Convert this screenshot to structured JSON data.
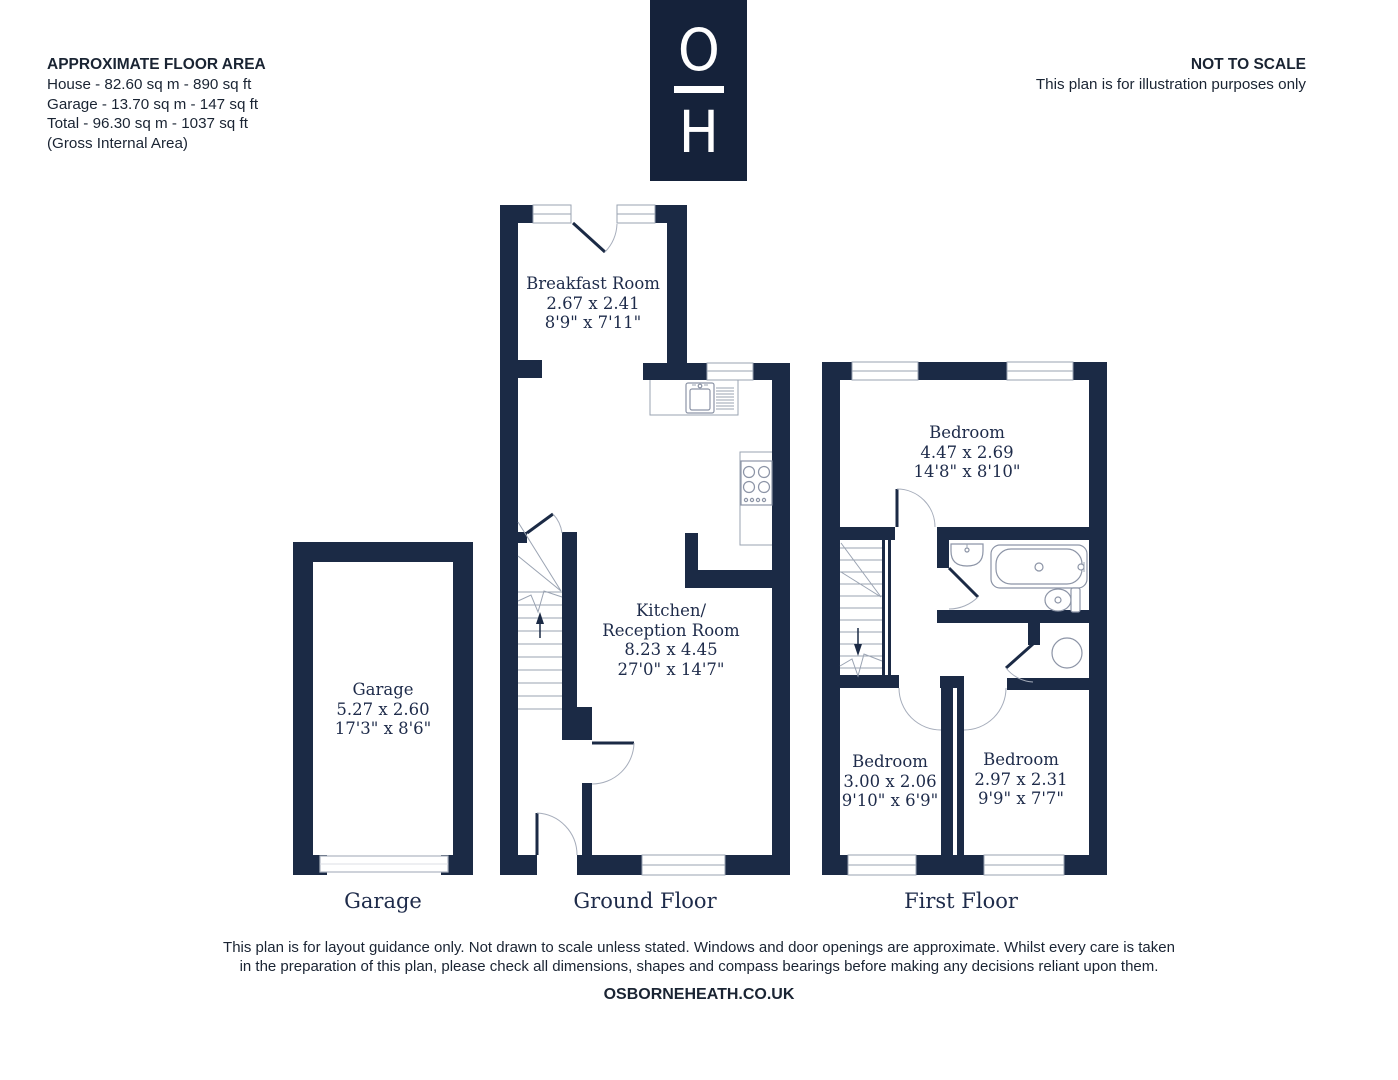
{
  "header": {
    "floor_area": {
      "title": "APPROXIMATE FLOOR AREA",
      "line1": "House - 82.60 sq m - 890 sq ft",
      "line2": "Garage - 13.70 sq m - 147 sq ft",
      "line3": "Total - 96.30 sq m - 1037 sq ft",
      "line4": "(Gross Internal Area)"
    },
    "scale_note": {
      "title": "NOT TO SCALE",
      "subtitle": "This plan is for illustration purposes only"
    }
  },
  "logo": {
    "letter_top": "O",
    "letter_bottom": "H"
  },
  "rooms": {
    "breakfast": {
      "name": "Breakfast Room",
      "metric": "2.67 x 2.41",
      "imperial": "8'9\" x 7'11\""
    },
    "kitchen": {
      "name_line1": "Kitchen/",
      "name_line2": "Reception Room",
      "metric": "8.23 x 4.45",
      "imperial": "27'0\" x 14'7\""
    },
    "garage": {
      "name": "Garage",
      "metric": "5.27 x 2.60",
      "imperial": "17'3\" x 8'6\""
    },
    "bedroom_main": {
      "name": "Bedroom",
      "metric": "4.47 x 2.69",
      "imperial": "14'8\" x 8'10\""
    },
    "bedroom_left": {
      "name": "Bedroom",
      "metric": "3.00 x 2.06",
      "imperial": "9'10\" x 6'9\""
    },
    "bedroom_right": {
      "name": "Bedroom",
      "metric": "2.97 x 2.31",
      "imperial": "9'9\" x 7'7\""
    }
  },
  "floor_labels": {
    "garage": "Garage",
    "ground": "Ground Floor",
    "first": "First Floor"
  },
  "footer": {
    "disclaimer_line1": "This plan is for layout guidance only. Not drawn to scale unless stated. Windows and door openings are approximate. Whilst every care is taken",
    "disclaimer_line2": "in the preparation of this plan, please check all dimensions, shapes and compass bearings before making any decisions reliant upon them.",
    "website": "OSBORNEHEATH.CO.UK"
  },
  "colors": {
    "wall": "#1b2a45",
    "logo_bg": "#15223a",
    "text": "#1e2b4a",
    "line": "#9aa3b2"
  }
}
